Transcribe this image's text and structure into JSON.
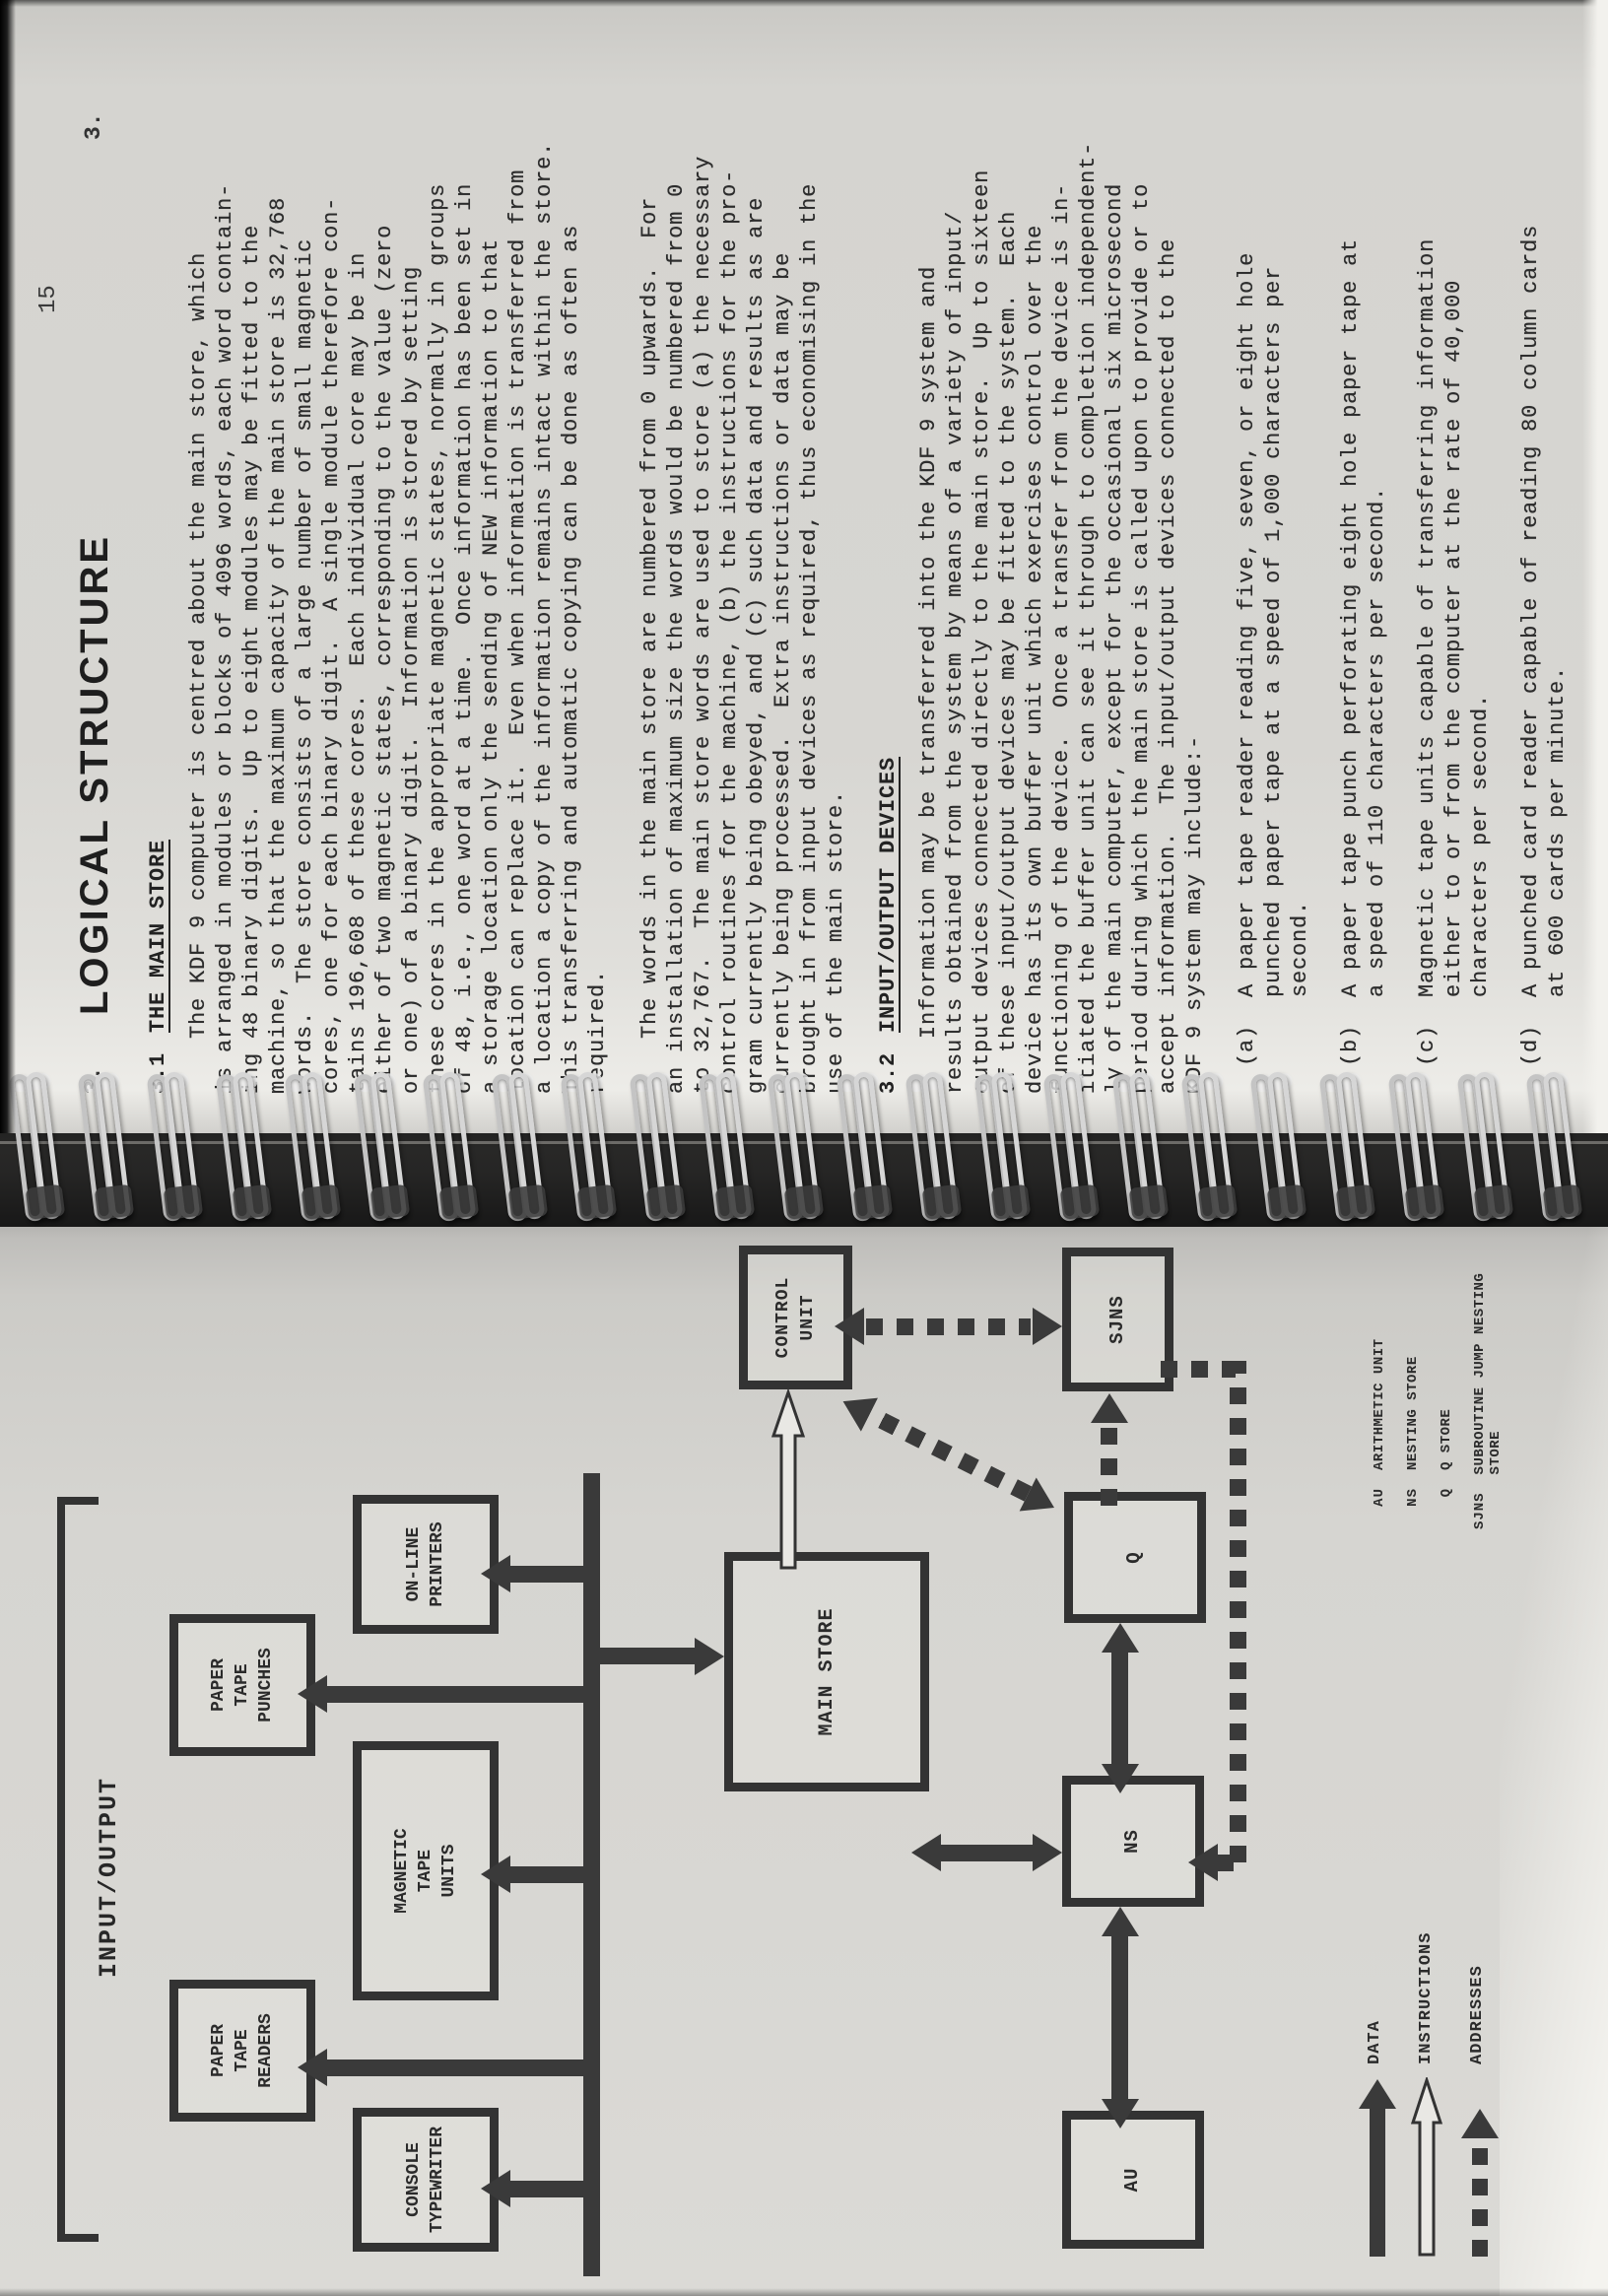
{
  "doc": {
    "page_number": "15",
    "chapter_marker_left": "3.",
    "chapter_marker_right": "3.",
    "title": "LOGICAL STRUCTURE",
    "sections": [
      {
        "number": "3.1",
        "heading": "THE MAIN STORE",
        "paragraphs": [
          [
            "    The KDF 9 computer is centred about the main store, which",
            "is arranged in modules or blocks of 4096 words, each word contain-",
            "ing 48 binary digits.  Up to eight modules may be fitted to the",
            "machine, so that the maximum capacity of the main store is 32,768",
            "words.  The store consists of a large number of small magnetic",
            "cores, one for each binary digit.  A single module therefore con-",
            "tains 196,608 of these cores.  Each individual core may be in",
            "either of two magnetic states, corresponding to the value (zero",
            "or one) of a binary digit.  Information is stored by setting",
            "these cores in the appropriate magnetic states, normally in groups",
            "of 48, i.e., one word at a time.  Once information has been set in",
            "a storage location only the sending of NEW information to that",
            "location can replace it.  Even when information is transferred from",
            "a location a copy of the information remains intact within the store.",
            "This transferring and automatic copying can be done as often as",
            "required."
          ],
          [
            "    The words in the main store are numbered from 0 upwards.  For",
            "an installation of maximum size the words would be numbered from 0",
            "to 32,767.  The main store words are used to store (a) the necessary",
            "control routines for the machine, (b) the instructions for the pro-",
            "gram currently being obeyed, and (c) such data and results as are",
            "currently being processed.  Extra instructions or data may be",
            "brought in from input devices as required, thus economising in the",
            "use of the main store."
          ]
        ]
      },
      {
        "number": "3.2",
        "heading": "INPUT/OUTPUT DEVICES",
        "paragraphs": [
          [
            "    Information may be transferred into the KDF 9 system and",
            "results obtained from the system by means of a variety of input/",
            "output devices connected directly to the main store.  Up to sixteen",
            "of these input/output devices may be fitted to the system.  Each",
            "device has its own buffer unit which exercises control over the",
            "functioning of the device.  Once a transfer from the device is in-",
            "itiated the buffer unit can see it through to completion independent-",
            "ly of the main computer, except for the occasional six microsecond",
            "period during which the main store is called upon to provide or to",
            "accept information.  The input/output devices connected to the",
            "KDF 9 system may include:-"
          ]
        ],
        "list": [
          {
            "lines": [
              "(a)  A paper tape reader reading five, seven, or eight hole",
              "     punched paper tape at a speed of 1,000 characters per",
              "     second."
            ]
          },
          {
            "lines": [
              "(b)  A paper tape punch perforating eight hole paper tape at",
              "     a speed of 110 characters per second."
            ]
          },
          {
            "lines": [
              "(c)  Magnetic tape units capable of transferring information",
              "     either to or from the computer at the rate of 40,000",
              "     characters per second."
            ]
          },
          {
            "lines": [
              "(d)  A punched card reader capable of reading 80 column cards",
              "     at 600 cards per minute."
            ]
          }
        ]
      }
    ]
  },
  "figure": {
    "group_label": "INPUT/OUTPUT",
    "boxes": {
      "paper_tape_readers": "PAPER\nTAPE\nREADERS",
      "paper_tape_punches": "PAPER\nTAPE\nPUNCHES",
      "console_typewriter": "CONSOLE\nTYPEWRITER",
      "magnetic_tape_units": "MAGNETIC\nTAPE\nUNITS",
      "online_printers": "ON-LINE\nPRINTERS",
      "main_store": "MAIN STORE",
      "control_unit": "CONTROL\nUNIT",
      "ns": "NS",
      "au": "AU",
      "q": "Q",
      "sjns": "SJNS"
    },
    "abbrev_legend": [
      {
        "abbr": "AU",
        "meaning": "ARITHMETIC UNIT"
      },
      {
        "abbr": "NS",
        "meaning": "NESTING STORE"
      },
      {
        "abbr": "Q",
        "meaning": "Q STORE"
      },
      {
        "abbr": "SJNS",
        "meaning": "SUBROUTINE JUMP NESTING STORE"
      }
    ],
    "arrow_legend": {
      "data": "DATA",
      "instructions": "INSTRUCTIONS",
      "addresses": "ADDRESSES"
    },
    "caption": "FIGURE 2",
    "ink_color": "#3a3a3a",
    "paper_color": "#d7d6d2"
  }
}
